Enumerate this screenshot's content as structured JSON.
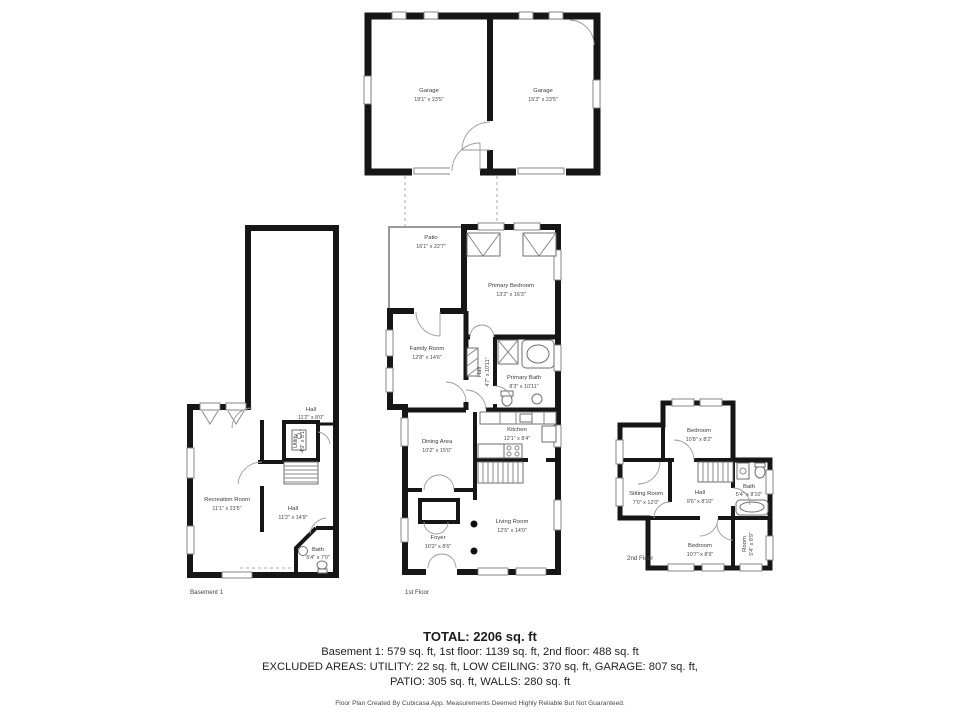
{
  "plans": {
    "garage": {
      "rooms": {
        "garage_left": {
          "name": "Garage",
          "dims": "19'1\" x 23'5\""
        },
        "garage_right": {
          "name": "Garage",
          "dims": "15'3\" x 23'5\""
        }
      }
    },
    "first_floor": {
      "label": "1st Floor",
      "rooms": {
        "patio": {
          "name": "Patio",
          "dims": "16'1\" x 22'7\""
        },
        "primary_bedroom": {
          "name": "Primary Bedroom",
          "dims": "13'2\" x 16'3\""
        },
        "family_room": {
          "name": "Family Room",
          "dims": "12'8\" x 14'6\""
        },
        "hall": {
          "name": "Hall",
          "dims": "4'7\" x 10'11\""
        },
        "primary_bath": {
          "name": "Primary Bath",
          "dims": "8'3\" x 10'11\""
        },
        "kitchen": {
          "name": "Kitchen",
          "dims": "12'1\" x 8'4\""
        },
        "dining_area": {
          "name": "Dining Area",
          "dims": "10'2\" x 15'0\""
        },
        "living_room": {
          "name": "Living Room",
          "dims": "12'5\" x 14'0\""
        },
        "foyer": {
          "name": "Foyer",
          "dims": "10'2\" x 8'6\""
        }
      }
    },
    "basement": {
      "label": "Basement 1",
      "rooms": {
        "hall_upper": {
          "name": "Hall",
          "dims": "11'2\" x 8'0\""
        },
        "utility": {
          "name": "Utility",
          "dims": "4'9\" x 5'1\""
        },
        "recreation_room": {
          "name": "Recreation Room",
          "dims": "11'1\" x 23'5\""
        },
        "hall": {
          "name": "Hall",
          "dims": "11'2\" x 14'9\""
        },
        "bath": {
          "name": "Bath",
          "dims": "5'4\" x 7'0\""
        }
      }
    },
    "second_floor": {
      "label": "2nd Floor",
      "rooms": {
        "bedroom_top": {
          "name": "Bedroom",
          "dims": "10'8\" x 8'2\""
        },
        "sitting_room": {
          "name": "Sitting Room",
          "dims": "7'0\" x 12'0\""
        },
        "hall": {
          "name": "Hall",
          "dims": "9'6\" x 8'10\""
        },
        "bath": {
          "name": "Bath",
          "dims": "5'4\" x 8'10\""
        },
        "bedroom_bottom": {
          "name": "Bedroom",
          "dims": "10'7\" x 8'9\""
        },
        "room": {
          "name": "Room",
          "dims": "5'4\" x 8'9\""
        }
      }
    }
  },
  "footer": {
    "total": "TOTAL: 2206 sq. ft",
    "floors": "Basement 1: 579 sq. ft, 1st floor: 1139 sq. ft, 2nd floor: 488 sq. ft",
    "excluded1": "EXCLUDED AREAS: UTILITY: 22 sq. ft, LOW CEILING: 370 sq. ft, GARAGE: 807 sq. ft,",
    "excluded2": "PATIO: 305 sq. ft, WALLS: 280 sq. ft",
    "disclaimer": "Floor Plan Created By Cubicasa App. Measurements Deemed Highly Reliable But Not Guaranteed."
  }
}
